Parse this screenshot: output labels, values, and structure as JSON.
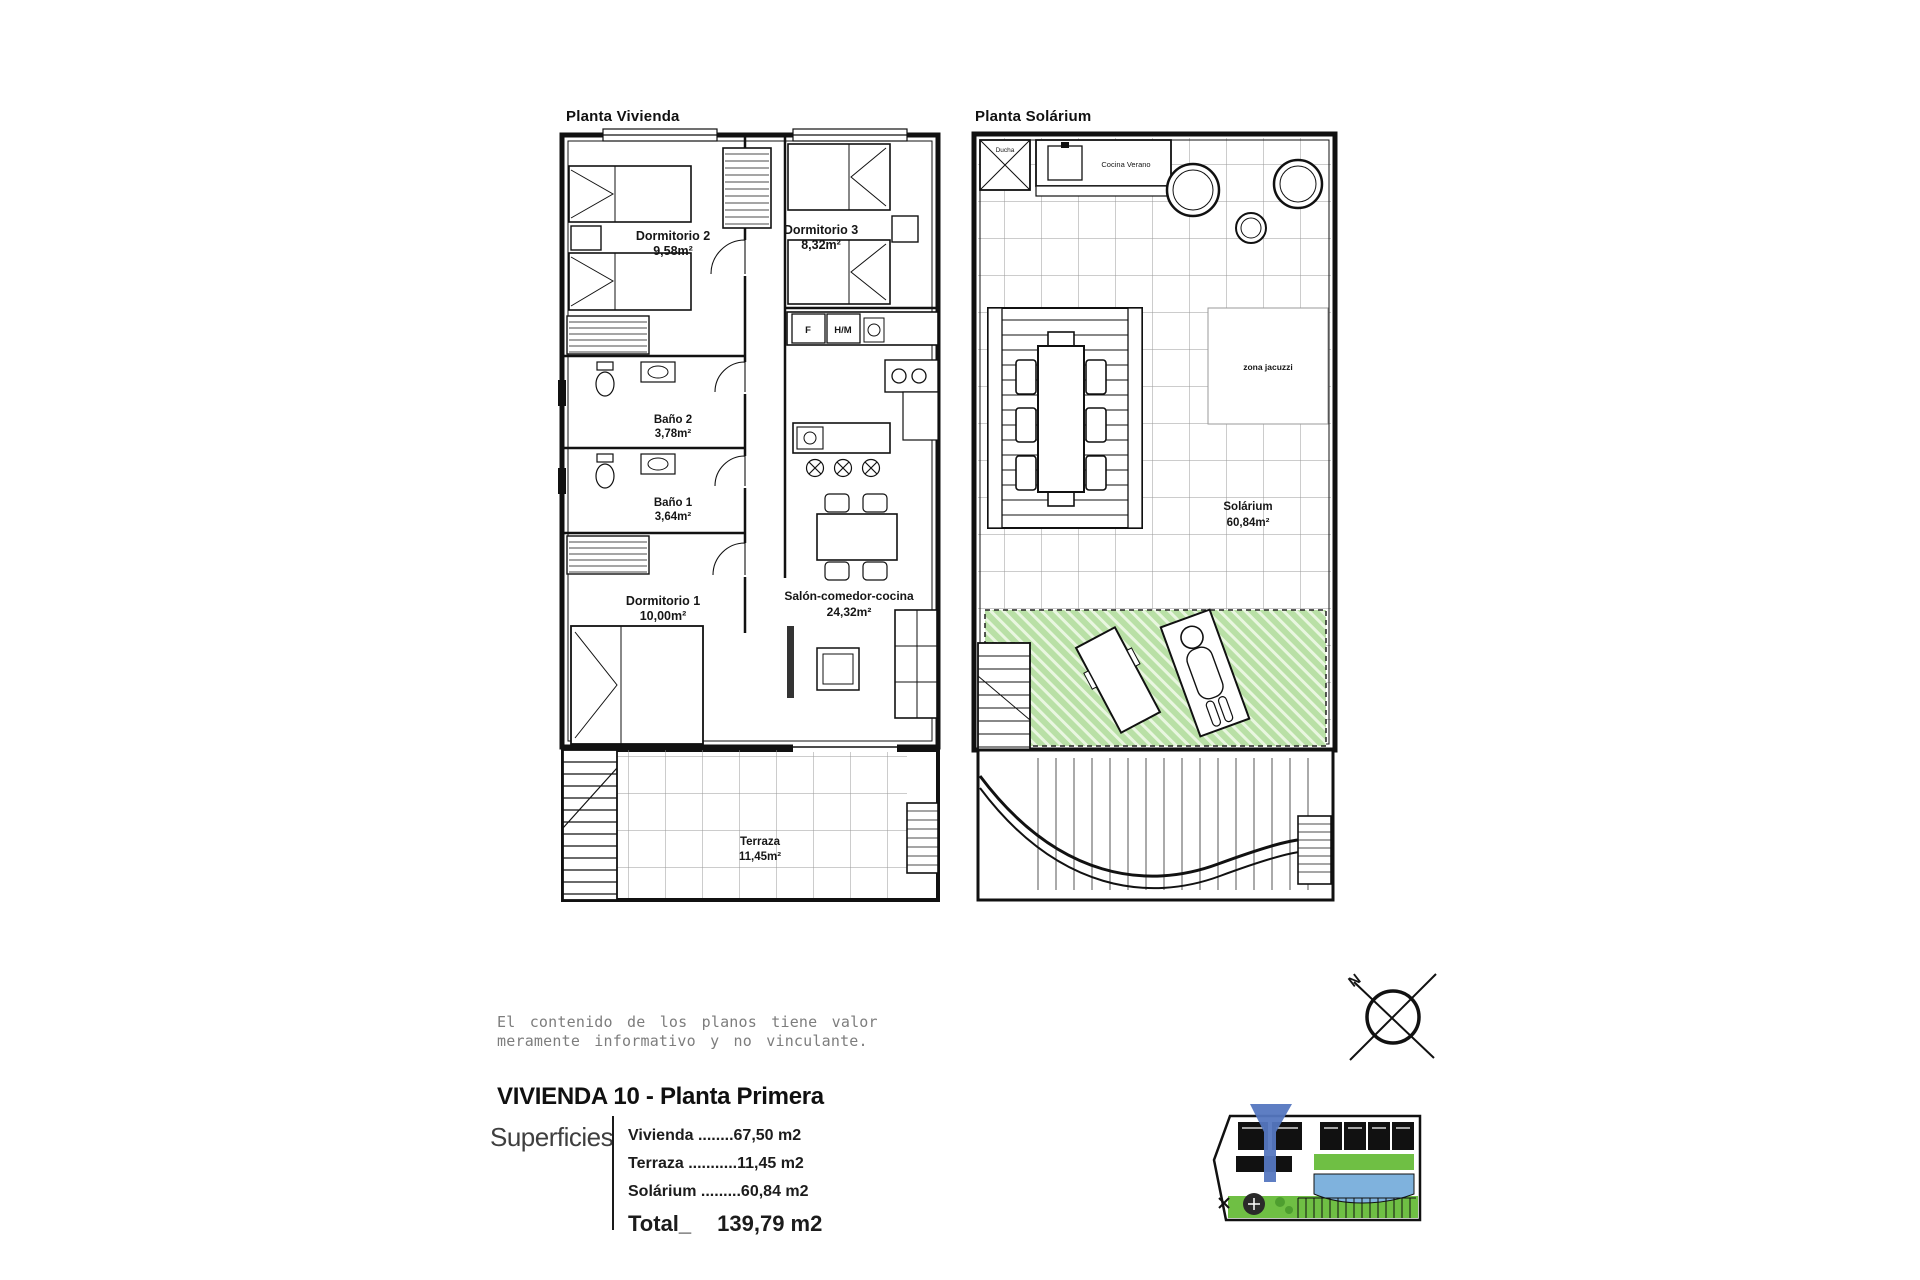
{
  "plan_vivienda": {
    "title": "Planta Vivienda",
    "rooms": {
      "dormitorio2": {
        "name": "Dormitorio 2",
        "area": "9,58m²"
      },
      "dormitorio3": {
        "name": "Dormitorio 3",
        "area": "8,32m²"
      },
      "bano2": {
        "name": "Baño 2",
        "area": "3,78m²"
      },
      "bano1": {
        "name": "Baño 1",
        "area": "3,64m²"
      },
      "dormitorio1": {
        "name": "Dormitorio 1",
        "area": "10,00m²"
      },
      "salon": {
        "name": "Salón-comedor-cocina",
        "area": "24,32m²"
      },
      "terraza": {
        "name": "Terraza",
        "area": "11,45m²"
      }
    },
    "appliances": {
      "fridge": "F",
      "washer": "H/M"
    }
  },
  "plan_solarium": {
    "title": "Planta Solárium",
    "shower": "Ducha",
    "summer_kitchen": "Cocina Verano",
    "jacuzzi_zone": "zona jacuzzi",
    "room": {
      "name": "Solárium",
      "area": "60,84m²"
    }
  },
  "disclaimer": {
    "line1": "El contenido de los planos tiene valor",
    "line2": "meramente informativo y no vinculante."
  },
  "title_block": {
    "title": "VIVIENDA 10 - Planta Primera",
    "superficies_label": "Superficies",
    "rows": [
      {
        "label": "Vivienda ",
        "leader": "........",
        "value": "67,50 m2"
      },
      {
        "label": "Terraza ",
        "leader": "...........",
        "value": "11,45 m2"
      },
      {
        "label": "Solárium ",
        "leader": ".........",
        "value": "60,84 m2"
      }
    ],
    "total_label": "Total_",
    "total_value": "139,79 m2"
  },
  "compass": {
    "north_label": "N"
  },
  "colors": {
    "line": "#1a1a1a",
    "tile_grid": "#9a9a9a",
    "green_fill": "#b9e0a6",
    "green_stripe": "#e9f6e0",
    "map_green": "#6fbf44",
    "map_pool": "#7fb2dd",
    "map_arrow": "#5577c0"
  }
}
